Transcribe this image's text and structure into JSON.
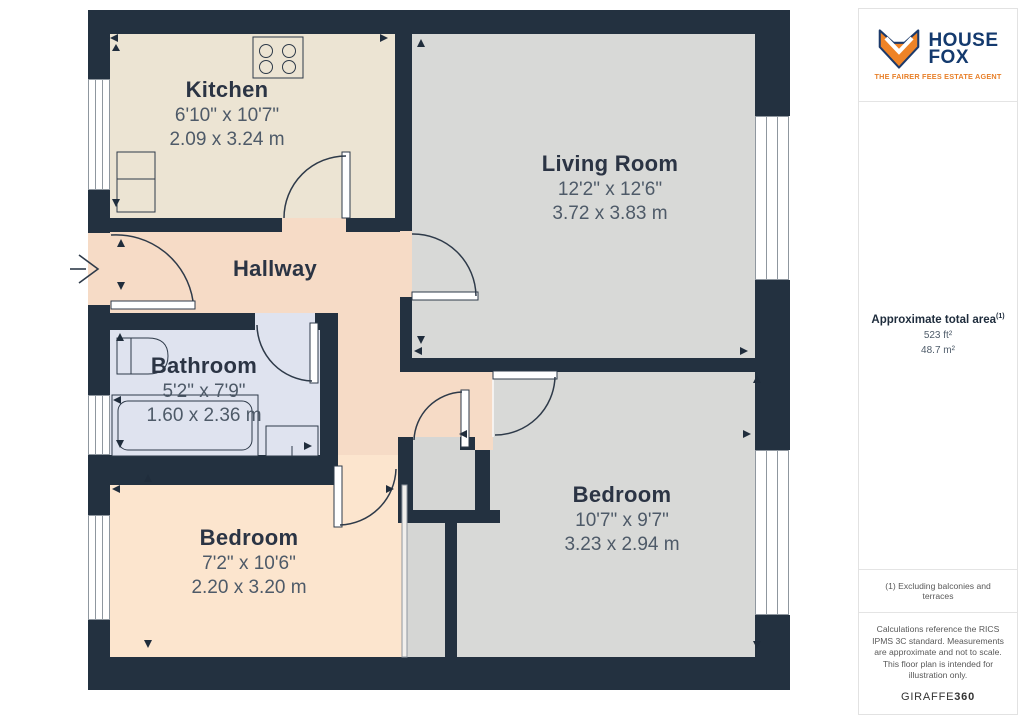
{
  "colors": {
    "wall": "#233140",
    "kitchen": "#ece4d3",
    "living_room": "#d8d9d7",
    "hallway": "#f6dbc6",
    "bathroom": "#dfe3ef",
    "bedroom_left": "#fce5ce",
    "bedroom_right": "#d8d9d7",
    "brand_navy": "#143a6e",
    "brand_orange": "#ee8327"
  },
  "plan": {
    "rooms": {
      "kitchen": {
        "name": "Kitchen",
        "imperial": "6'10\" x 10'7\"",
        "metric": "2.09 x 3.24 m"
      },
      "living_room": {
        "name": "Living Room",
        "imperial": "12'2\" x 12'6\"",
        "metric": "3.72 x 3.83 m"
      },
      "hallway": {
        "name": "Hallway"
      },
      "bathroom": {
        "name": "Bathroom",
        "imperial": "5'2\" x 7'9\"",
        "metric": "1.60 x 2.36 m"
      },
      "bedroom_left": {
        "name": "Bedroom",
        "imperial": "7'2\" x 10'6\"",
        "metric": "2.20 x 3.20 m"
      },
      "bedroom_right": {
        "name": "Bedroom",
        "imperial": "10'7\" x 9'7\"",
        "metric": "3.23 x 2.94 m"
      }
    }
  },
  "sidebar": {
    "logo": {
      "line1": "HOUSE",
      "line2": "FOX",
      "tagline": "THE FAIRER FEES ESTATE AGENT"
    },
    "area": {
      "label": "Approximate total area",
      "sup": "(1)",
      "imperial": "523 ft²",
      "metric": "48.7 m²"
    },
    "footnote": "(1) Excluding balconies and terraces",
    "disclaimer": "Calculations reference the RICS IPMS 3C standard. Measurements are approximate and not to scale. This floor plan is intended for illustration only.",
    "brand": {
      "name": "GIRAFFE",
      "suffix": "360"
    }
  }
}
